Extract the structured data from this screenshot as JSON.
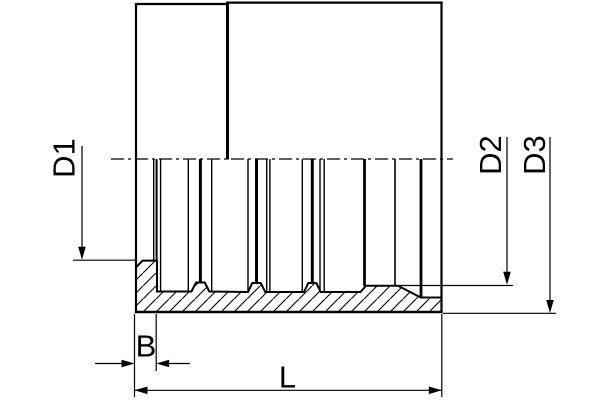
{
  "drawing": {
    "type": "technical-section-drawing",
    "subject": "hose-ferrule-cross-section",
    "labels": {
      "d1": "D1",
      "d2": "D2",
      "d3": "D3",
      "b": "B",
      "l": "L"
    },
    "colors": {
      "line": "#000000",
      "background": "#ffffff"
    }
  }
}
